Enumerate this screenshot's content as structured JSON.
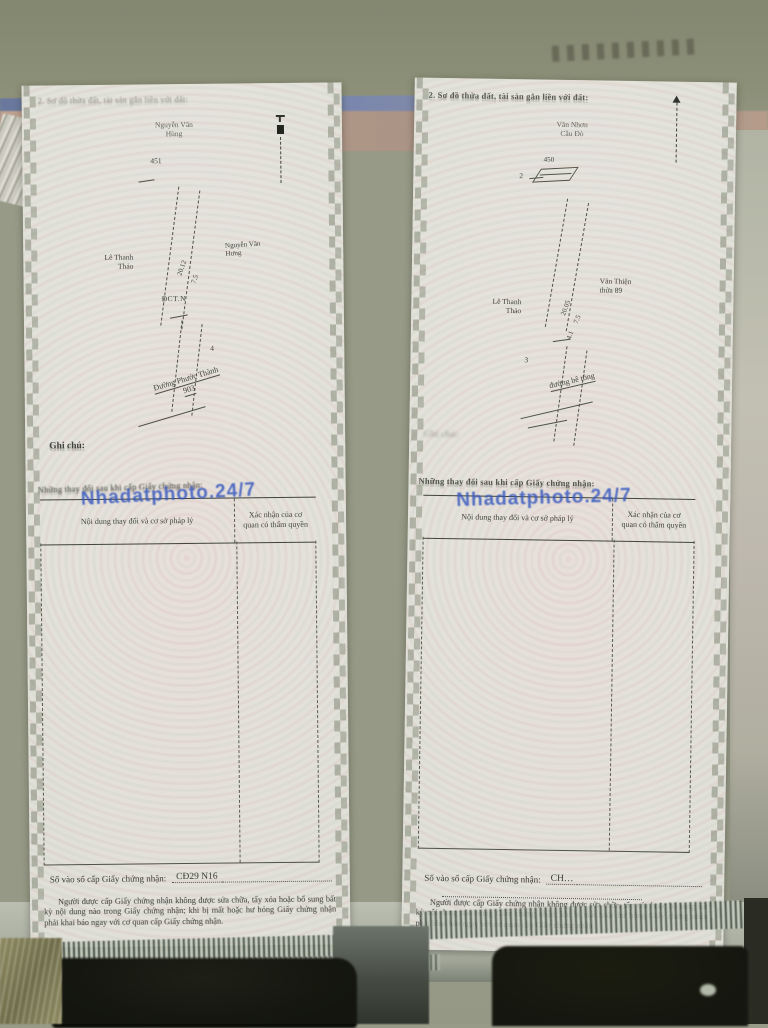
{
  "shared": {
    "watermark": "Nhadatphoto.24/7",
    "watermark_color": "#2e52c4",
    "diagram_heading": "2. Sơ đồ thửa đất, tài sản gắn liền với đất:",
    "note_label": "Ghi chú:",
    "changes_title": "Những thay đổi sau khi cấp Giấy chứng nhận:",
    "table": {
      "col1": "Nội dung thay đổi và cơ sở pháp lý",
      "col2": "Xác nhận của cơ quan có thẩm quyền"
    },
    "serial_label": "Số vào sổ cấp Giấy chứng nhận:",
    "legal_note": "Người được cấp Giấy chứng nhận không được sửa chữa, tẩy xóa hoặc bổ sung bất kỳ nội dung nào trong Giấy chứng nhận; khi bị mất hoặc hư hỏng Giấy chứng nhận phải khai báo ngay với cơ quan cấp Giấy chứng nhận."
  },
  "documents": {
    "left": {
      "adjacent_top_1": "Nguyễn Văn",
      "adjacent_top_2": "Hùng",
      "parcel_number": "451",
      "owner_left_1": "Lê Thanh",
      "owner_left_2": "Thảo",
      "owner_right_1": "Nguyễn Văn",
      "owner_right_2": "Hưng",
      "measure_1": "20.12",
      "measure_2": "7.5",
      "land_code": "ĐCT.N",
      "bottom_tick": "4",
      "road_1": "Đường Phước Thành",
      "road_2": "903",
      "serial_value": "CĐ29 N16"
    },
    "right": {
      "adjacent_top_1": "Văn Nhơn",
      "adjacent_top_2": "Cầu Đò",
      "parcel_number": "450",
      "top_tick": "2",
      "owner_left_1": "Lê Thanh",
      "owner_left_2": "Thảo",
      "owner_right_1": "Văn Thiện",
      "owner_right_2": "thửa 89",
      "measure_1": "20.05",
      "measure_2": "7.5",
      "measure_3": "4.1",
      "bottom_tick": "3",
      "road_1": "đường bê tông",
      "serial_value": "CH…"
    }
  }
}
